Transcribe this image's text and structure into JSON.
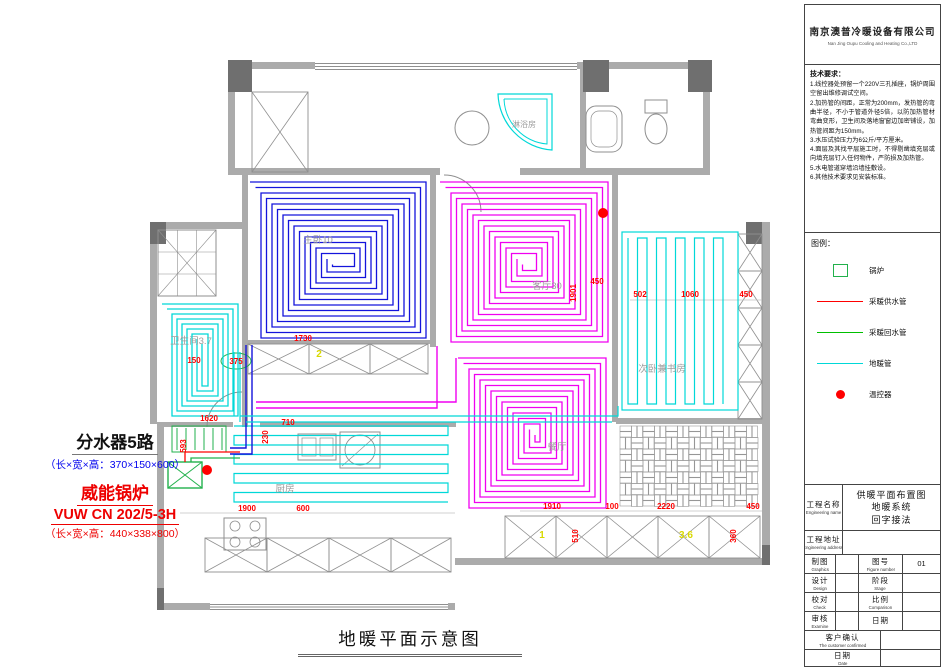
{
  "company": {
    "name_cn": "南京澳普冷暖设备有限公司",
    "name_en": "Nan Jing Oupu Cooling and Heating Co.,LTD"
  },
  "tech": {
    "title": "技术要求：",
    "items": [
      "1.线控器处预留一个220V三孔插座，锅炉周围空留出维修调试空间。",
      "2.加热管的间距，正常为200mm，发热管的弯曲半径，不小于管道外径5倍，以防加热管材弯曲变形，卫生间及落地窗窗边加密铺设，加热管间距为150mm。",
      "3.水压试验压力为6公斤/平方厘米。",
      "4.面层及其找平层施工时，不得剔凿填充层或向填充层钉入任何物件，严防损及加热管。",
      "5.水电管道穿墙沿墙挂敷设。",
      "6.其他技术要求见安装标准。"
    ]
  },
  "legend": {
    "title": "图例：",
    "items": [
      {
        "symbol": "boiler-square",
        "color": "#22b14c",
        "label": "锅炉"
      },
      {
        "symbol": "line",
        "color": "#ff0000",
        "label": "采暖供水管"
      },
      {
        "symbol": "line",
        "color": "#00c000",
        "label": "采暖回水管"
      },
      {
        "symbol": "line",
        "color": "#00d8d8",
        "label": "地暖管"
      },
      {
        "symbol": "dot",
        "color": "#ff0000",
        "label": "温控器"
      }
    ]
  },
  "title_block": {
    "project_name_label": "工程名称",
    "project_name_label_en": "Engineering name",
    "project_name_lines": [
      "供暖平面布置图",
      "地暖系统",
      "回字接法"
    ],
    "address_label": "工程地址",
    "address_label_en": "Engineering address",
    "graphics_label": "制图",
    "graphics_label_en": "Graphics",
    "number_label": "图号",
    "number_label_en": "Figure number",
    "figure_number": "01",
    "design_label": "设计",
    "design_label_en": "Design",
    "stage_label": "阶段",
    "stage_label_en": "Stage",
    "check_label": "校对",
    "check_label_en": "Check",
    "scale_label": "比例",
    "scale_label_en": "Comparison",
    "examine_label": "审核",
    "examine_label_en": "Examine",
    "date_small_label": "日期",
    "customer_label": "客户确认",
    "customer_label_en": "The customer confirmed",
    "date_label": "日期",
    "date_label_en": "Date"
  },
  "annotations": {
    "manifold_title": "分水器5路",
    "manifold_dims": "（长×宽×高：370×150×600）",
    "boiler_title": "威能锅炉",
    "boiler_model": "VUW CN 202/5-3H",
    "boiler_dims": "（长×宽×高：440×338×800）",
    "drawing_title": "地暖平面示意图"
  },
  "plan": {
    "colors": {
      "wall": "#ababab",
      "column": "#6f6f6f",
      "fixture": "#8f8f8f",
      "blue": "#1414dc",
      "magenta": "#f000f0",
      "cyan": "#00d8d8",
      "red": "#ff0000",
      "green": "#22b14c",
      "yellow": "#d8d800",
      "text": "#9c9c9c"
    },
    "rooms": [
      {
        "name": "master-bedroom",
        "coil": "spiral",
        "color": "#1414dc",
        "rect": [
          250,
          182,
          176,
          156
        ],
        "gap": 11
      },
      {
        "name": "living-room",
        "coil": "spiral",
        "color": "#f000f0",
        "rect": [
          440,
          182,
          168,
          160
        ],
        "gap": 11
      },
      {
        "name": "dining-room",
        "coil": "spiral",
        "color": "#f000f0",
        "rect": [
          458,
          358,
          148,
          150
        ],
        "gap": 11
      },
      {
        "name": "bathroom",
        "coil": "spiral",
        "color": "#00d8d8",
        "rect": [
          162,
          304,
          76,
          112
        ],
        "gap": 10
      },
      {
        "name": "study-bedroom",
        "coil": "serp-v",
        "color": "#00d8d8",
        "rect": [
          628,
          238,
          104,
          166
        ],
        "gap": 9.5,
        "outer": [
          622,
          232,
          116,
          178
        ]
      },
      {
        "name": "kitchen",
        "coil": "serp-h",
        "color": "#00d8d8",
        "rect": [
          234,
          426,
          214,
          84
        ],
        "gap": 9.5
      }
    ],
    "room_labels": [
      {
        "text": "主卧10",
        "x": 318,
        "y": 243
      },
      {
        "text": "客厅30",
        "x": 547,
        "y": 289
      },
      {
        "text": "次卧兼书房",
        "x": 662,
        "y": 372
      },
      {
        "text": "餐厅",
        "x": 557,
        "y": 450
      },
      {
        "text": "厨房",
        "x": 285,
        "y": 492
      },
      {
        "text": "卫生间3.7",
        "x": 191,
        "y": 344
      },
      {
        "text": "淋浴房",
        "x": 524,
        "y": 127,
        "size": 8
      }
    ],
    "dim_labels": [
      {
        "text": "1730",
        "x": 303,
        "y": 341,
        "color": "#ff0000"
      },
      {
        "text": "1620",
        "x": 209,
        "y": 421,
        "color": "#ff0000"
      },
      {
        "text": "593",
        "x": 186,
        "y": 446,
        "color": "#ff0000",
        "rot": -90
      },
      {
        "text": "230",
        "x": 268,
        "y": 437,
        "color": "#ff0000",
        "rot": -90
      },
      {
        "text": "710",
        "x": 288,
        "y": 425,
        "color": "#ff0000"
      },
      {
        "text": "1900",
        "x": 247,
        "y": 511,
        "color": "#ff0000"
      },
      {
        "text": "600",
        "x": 303,
        "y": 511,
        "color": "#ff0000"
      },
      {
        "text": "1910",
        "x": 552,
        "y": 509,
        "color": "#ff0000"
      },
      {
        "text": "100",
        "x": 612,
        "y": 509,
        "color": "#ff0000"
      },
      {
        "text": "2220",
        "x": 666,
        "y": 509,
        "color": "#ff0000"
      },
      {
        "text": "450",
        "x": 753,
        "y": 509,
        "color": "#ff0000"
      },
      {
        "text": "510",
        "x": 578,
        "y": 536,
        "color": "#ff0000",
        "rot": -90
      },
      {
        "text": "360",
        "x": 736,
        "y": 536,
        "color": "#ff0000",
        "rot": -90
      },
      {
        "text": "150",
        "x": 194,
        "y": 363,
        "color": "#ff0000"
      },
      {
        "text": "375",
        "x": 236,
        "y": 364,
        "color": "#ff0000"
      },
      {
        "text": "1901",
        "x": 576,
        "y": 293,
        "color": "#ff0000",
        "rot": -90
      },
      {
        "text": "450",
        "x": 597,
        "y": 284,
        "color": "#ff0000"
      },
      {
        "text": "502",
        "x": 640,
        "y": 297,
        "color": "#ff0000"
      },
      {
        "text": "1060",
        "x": 690,
        "y": 297,
        "color": "#ff0000"
      },
      {
        "text": "450",
        "x": 746,
        "y": 297,
        "color": "#ff0000"
      },
      {
        "text": "2",
        "x": 319,
        "y": 357,
        "color": "#d8d800",
        "size": 10
      },
      {
        "text": "1",
        "x": 542,
        "y": 538,
        "color": "#d8d800",
        "size": 10
      },
      {
        "text": "3.6",
        "x": 686,
        "y": 538,
        "color": "#d8d800",
        "size": 10
      }
    ],
    "pipes": [
      {
        "color": "#1414dc",
        "w": 1.4,
        "pts": [
          [
            246,
            345
          ],
          [
            246,
            448
          ],
          [
            230,
            448
          ]
        ]
      },
      {
        "color": "#1414dc",
        "w": 1.4,
        "pts": [
          [
            252,
            345
          ],
          [
            252,
            454
          ],
          [
            230,
            454
          ]
        ]
      },
      {
        "color": "#f000f0",
        "w": 1.4,
        "pts": [
          [
            256,
            402
          ],
          [
            456,
            402
          ],
          [
            456,
            358
          ]
        ]
      },
      {
        "color": "#f000f0",
        "w": 1.4,
        "pts": [
          [
            256,
            408
          ],
          [
            437,
            408
          ],
          [
            437,
            346
          ]
        ]
      },
      {
        "color": "#00d8d8",
        "w": 1.2,
        "pts": [
          [
            240,
            416
          ],
          [
            618,
            416
          ],
          [
            618,
            406
          ]
        ]
      },
      {
        "color": "#00d8d8",
        "w": 1.2,
        "pts": [
          [
            246,
            422
          ],
          [
            612,
            422
          ]
        ]
      },
      {
        "color": "#00d8d8",
        "w": 1.2,
        "pts": [
          [
            234,
            352
          ],
          [
            234,
            416
          ]
        ]
      },
      {
        "color": "#00d8d8",
        "w": 1.2,
        "pts": [
          [
            240,
            352
          ],
          [
            240,
            422
          ]
        ]
      },
      {
        "color": "#ff0000",
        "w": 1.3,
        "pts": [
          [
            185,
            462
          ],
          [
            185,
            452
          ],
          [
            240,
            452
          ]
        ]
      },
      {
        "color": "#22b14c",
        "w": 1.3,
        "pts": [
          [
            191,
            462
          ],
          [
            191,
            458
          ],
          [
            240,
            458
          ]
        ]
      }
    ],
    "thermostats": [
      [
        603,
        213
      ],
      [
        207,
        470
      ]
    ]
  }
}
